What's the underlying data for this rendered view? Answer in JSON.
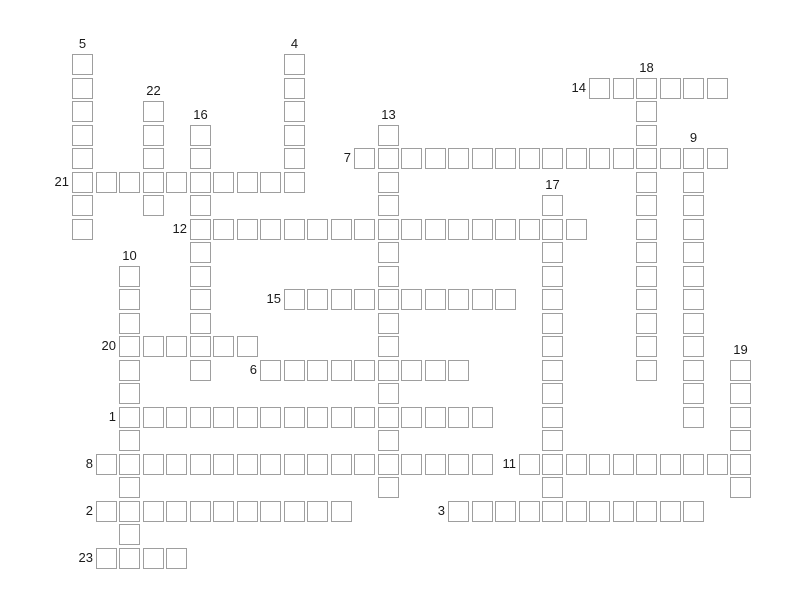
{
  "board": {
    "background": "#ffffff",
    "origin": {
      "x": 72,
      "y": 54
    },
    "cell": {
      "size": 21,
      "pitch": 23.5,
      "fill": "#ffffff",
      "border_color": "#9e9e9e"
    },
    "number_color": "#1a1a1a",
    "rows": 22,
    "cols": 29,
    "entries": [
      {
        "num": "1",
        "dir": "across",
        "row": 15,
        "col": 2,
        "len": 16
      },
      {
        "num": "2",
        "dir": "across",
        "row": 19,
        "col": 1,
        "len": 11
      },
      {
        "num": "3",
        "dir": "across",
        "row": 19,
        "col": 16,
        "len": 11
      },
      {
        "num": "4",
        "dir": "down",
        "row": 0,
        "col": 9,
        "len": 6
      },
      {
        "num": "5",
        "dir": "down",
        "row": 0,
        "col": 0,
        "len": 8
      },
      {
        "num": "6",
        "dir": "across",
        "row": 13,
        "col": 8,
        "len": 9
      },
      {
        "num": "7",
        "dir": "across",
        "row": 4,
        "col": 12,
        "len": 16
      },
      {
        "num": "8",
        "dir": "across",
        "row": 17,
        "col": 1,
        "len": 17
      },
      {
        "num": "9",
        "dir": "down",
        "row": 4,
        "col": 26,
        "len": 12
      },
      {
        "num": "10",
        "dir": "down",
        "row": 9,
        "col": 2,
        "len": 13
      },
      {
        "num": "11",
        "dir": "across",
        "row": 17,
        "col": 19,
        "len": 10
      },
      {
        "num": "12",
        "dir": "across",
        "row": 7,
        "col": 5,
        "len": 17
      },
      {
        "num": "13",
        "dir": "down",
        "row": 3,
        "col": 13,
        "len": 16
      },
      {
        "num": "14",
        "dir": "across",
        "row": 1,
        "col": 22,
        "len": 6
      },
      {
        "num": "15",
        "dir": "across",
        "row": 10,
        "col": 9,
        "len": 10
      },
      {
        "num": "16",
        "dir": "down",
        "row": 3,
        "col": 5,
        "len": 11
      },
      {
        "num": "17",
        "dir": "down",
        "row": 6,
        "col": 20,
        "len": 14
      },
      {
        "num": "18",
        "dir": "down",
        "row": 1,
        "col": 24,
        "len": 13
      },
      {
        "num": "19",
        "dir": "down",
        "row": 13,
        "col": 28,
        "len": 6
      },
      {
        "num": "20",
        "dir": "across",
        "row": 12,
        "col": 2,
        "len": 6
      },
      {
        "num": "21",
        "dir": "across",
        "row": 5,
        "col": 0,
        "len": 10
      },
      {
        "num": "22",
        "dir": "down",
        "row": 2,
        "col": 3,
        "len": 5
      },
      {
        "num": "23",
        "dir": "across",
        "row": 21,
        "col": 1,
        "len": 4
      }
    ]
  }
}
